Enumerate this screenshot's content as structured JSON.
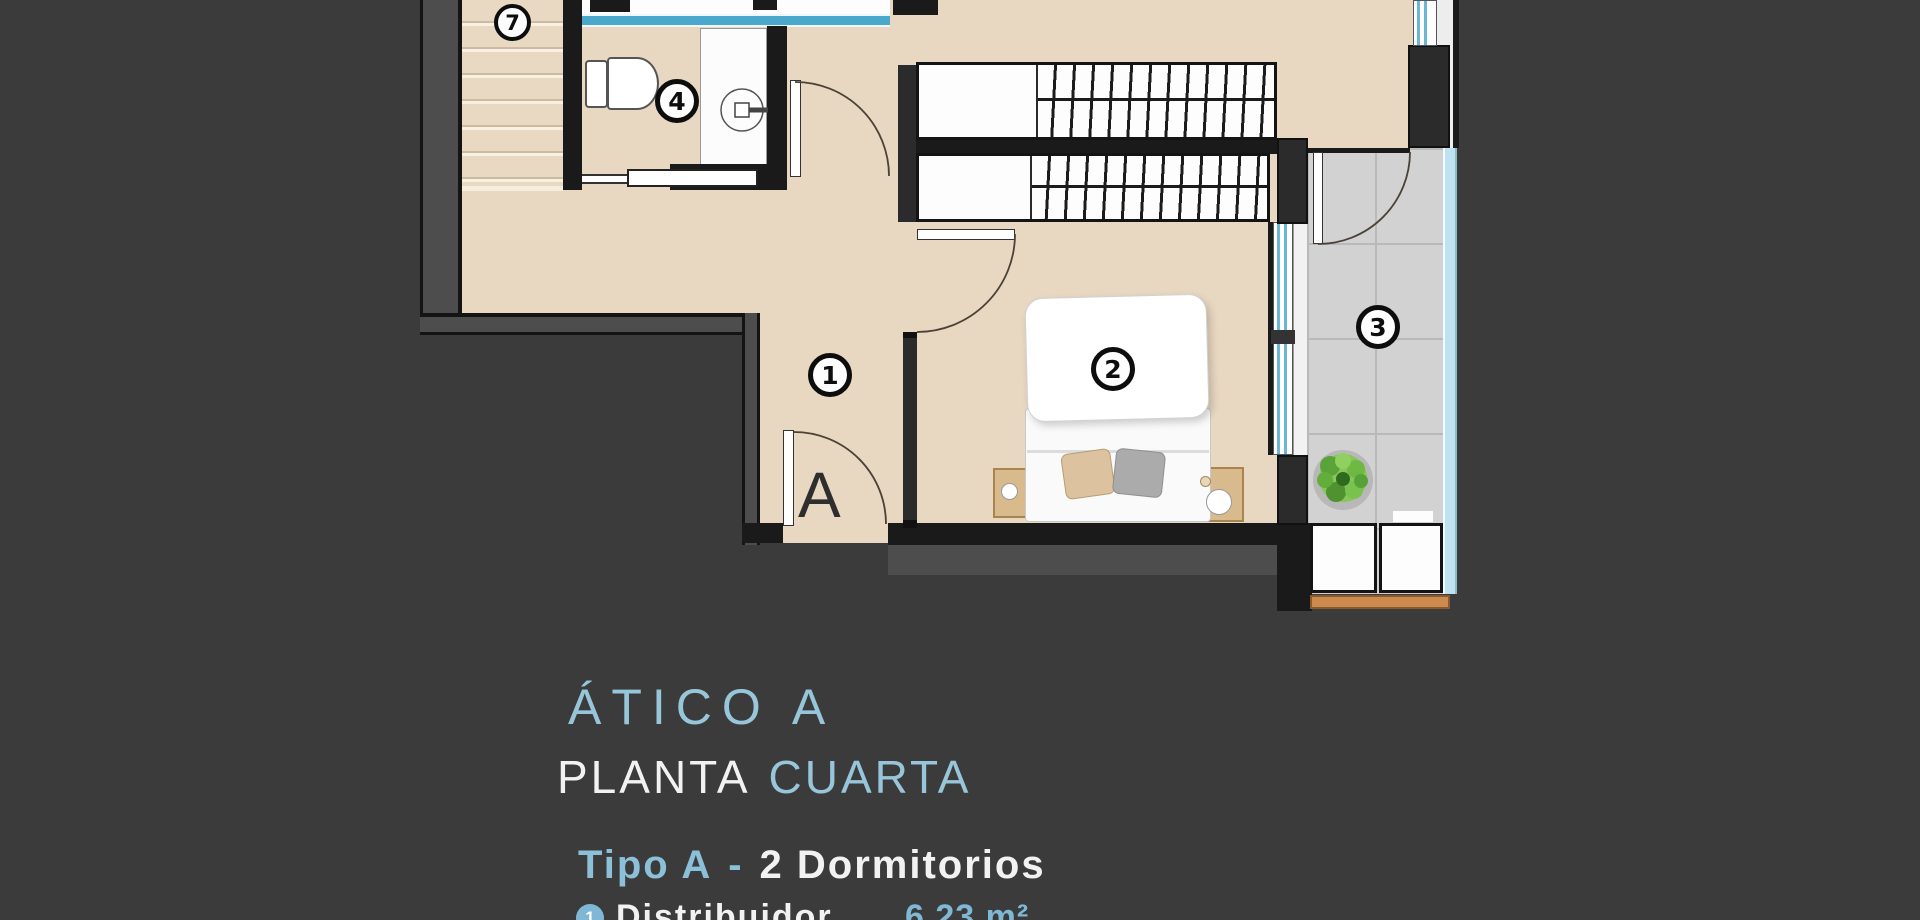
{
  "plan": {
    "markers": [
      {
        "number": "7"
      },
      {
        "number": "4"
      },
      {
        "number": "1"
      },
      {
        "number": "2"
      },
      {
        "number": "3"
      }
    ],
    "entrance_label": "A"
  },
  "titles": {
    "line1": "ÁTICO A",
    "line2_part1": "PLANTA",
    "line2_part2": "CUARTA",
    "subtitle_part1": "Tipo A",
    "subtitle_dash": "-",
    "subtitle_part2": "2  Dormitorios"
  },
  "legend": {
    "items": [
      {
        "number": "1",
        "label": "Distribuidor",
        "value": "6.23 m²"
      }
    ]
  },
  "colors": {
    "background": "#3b3b3b",
    "accent_blue": "#8fc3da",
    "text_white": "#f2f2f2",
    "floor_beige": "#e8d7c1",
    "wall_dark": "#1a1a1a",
    "wall_gray": "#4d4d4d",
    "glass_blue": "#4aa8cc",
    "tile_gray": "#d2d2d2",
    "wood": "#cd8a4f",
    "plant_green": "#6fbf44"
  }
}
